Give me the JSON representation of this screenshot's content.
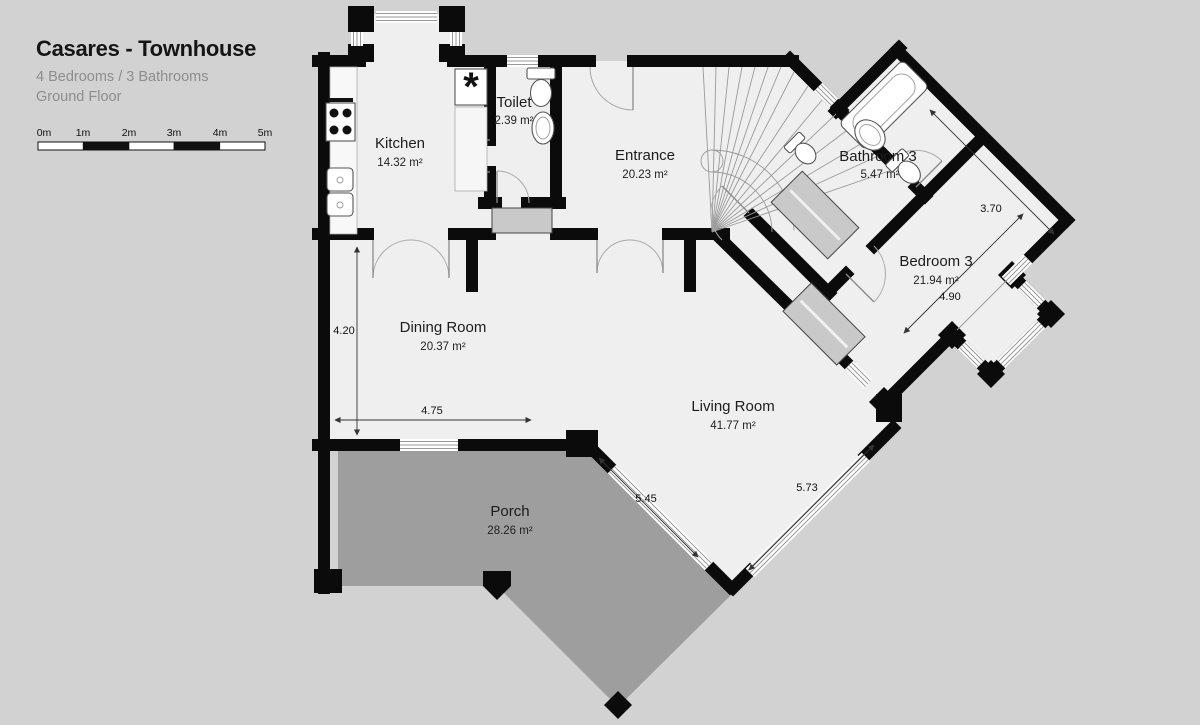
{
  "header": {
    "title": "Casares - Townhouse",
    "subtitle": "4 Bedrooms / 3 Bathrooms",
    "floor": "Ground Floor"
  },
  "scale_bar": {
    "labels": [
      "0m",
      "1m",
      "2m",
      "3m",
      "4m",
      "5m"
    ]
  },
  "rooms": [
    {
      "name": "Kitchen",
      "area": "14.32 m²"
    },
    {
      "name": "Toilet",
      "area": "2.39 m²"
    },
    {
      "name": "Entrance",
      "area": "20.23 m²"
    },
    {
      "name": "Bathroom 3",
      "area": "5.47 m²"
    },
    {
      "name": "Bedroom 3",
      "area": "21.94 m²"
    },
    {
      "name": "Dining Room",
      "area": "20.37 m²"
    },
    {
      "name": "Living Room",
      "area": "41.77 m²"
    },
    {
      "name": "Porch",
      "area": "28.26 m²"
    }
  ],
  "dimensions": {
    "dining_height": "4.20",
    "dining_width": "4.75",
    "living_sw": "5.45",
    "living_se": "5.73",
    "bedroom_ne": "3.70",
    "bedroom_se": "4.90"
  },
  "fixtures": {
    "appliance_symbol": "*"
  },
  "colors": {
    "background": "#d2d2d2",
    "floor": "#efefef",
    "porch": "#9e9e9e",
    "wall": "#0b0b0b"
  }
}
